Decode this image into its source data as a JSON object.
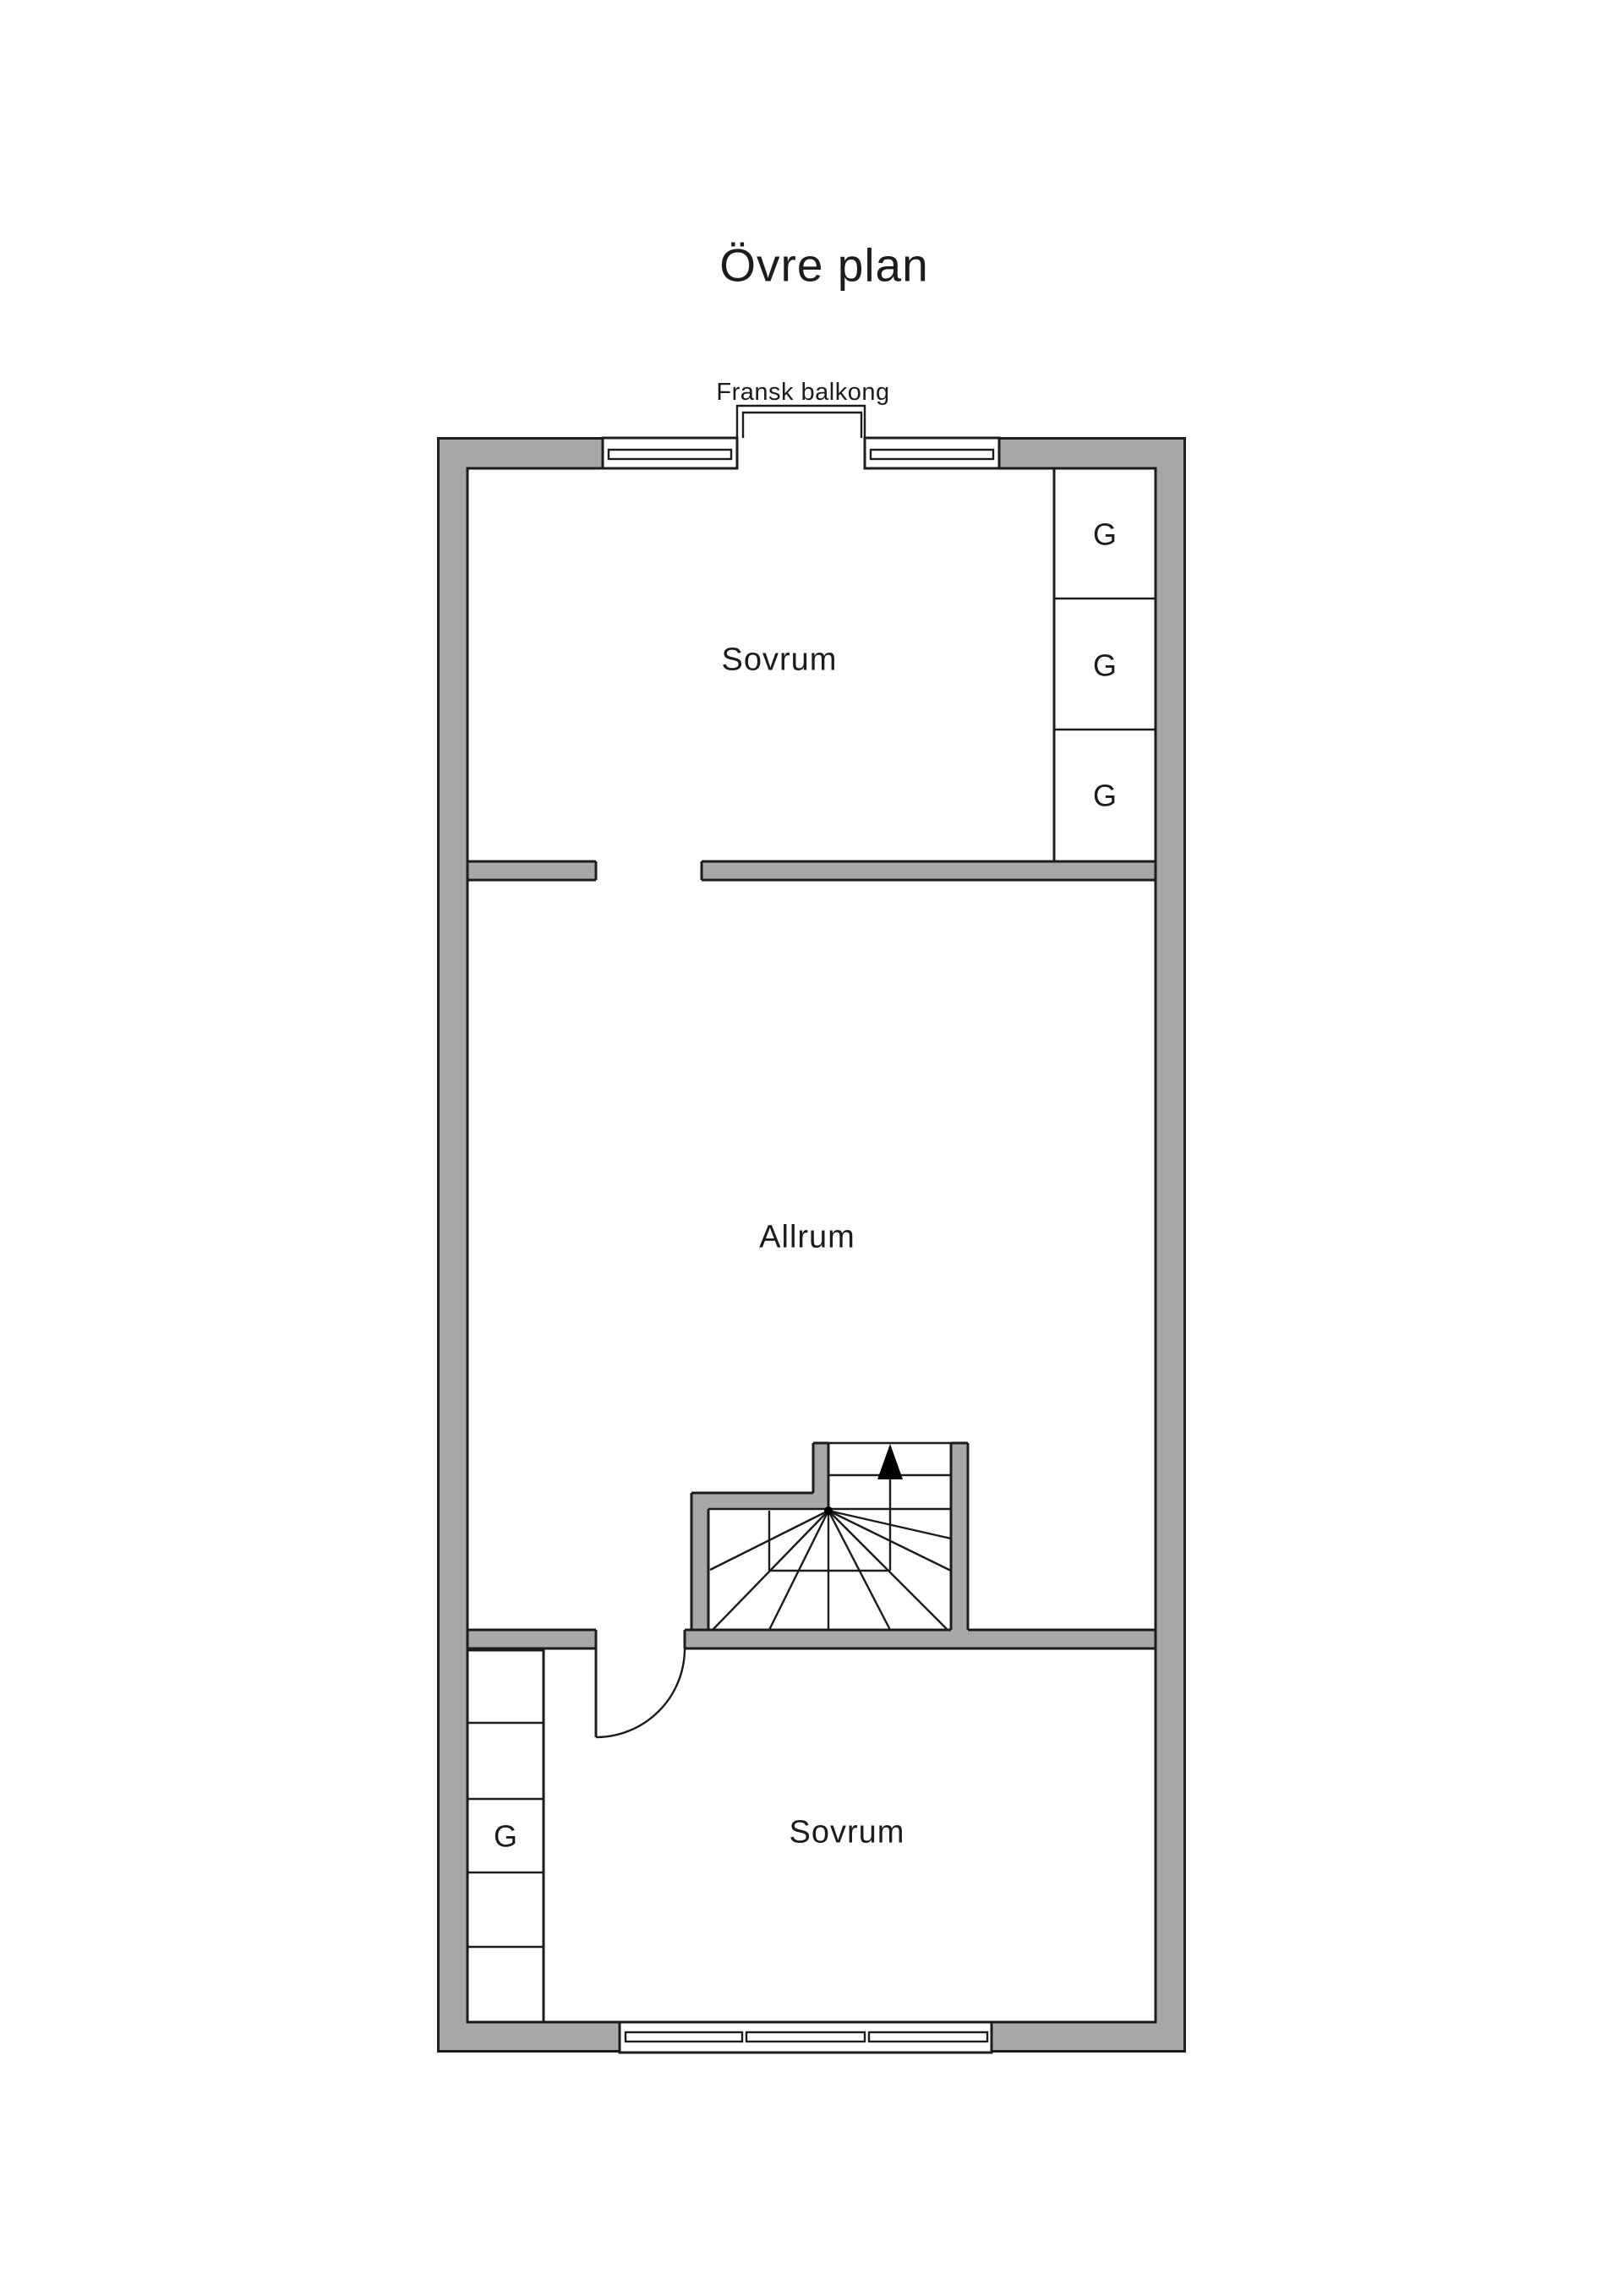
{
  "title": "Övre plan",
  "balcony": {
    "label": "Fransk balkong"
  },
  "rooms": {
    "bedroom_top": "Sovrum",
    "living_room": "Allrum",
    "bedroom_bottom": "Sovrum"
  },
  "wardrobes": {
    "top_right": [
      "G",
      "G",
      "G"
    ],
    "bottom_left": [
      "G"
    ]
  },
  "colors": {
    "wall_fill": "#a8a8a8",
    "outline": "#1c1c1c",
    "floor": "#ffffff",
    "stair_arrow": "#000000"
  }
}
